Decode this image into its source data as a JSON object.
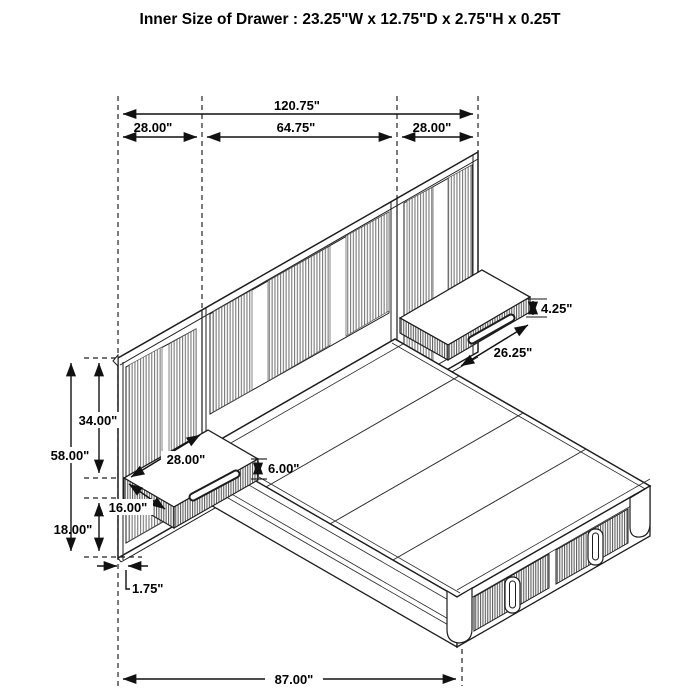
{
  "title": "Inner Size of Drawer : 23.25\"W x 12.75\"D x 2.75\"H x 0.25T",
  "dims": {
    "overall_width": "120.75\"",
    "left_panel_width": "28.00\"",
    "center_panel_width": "64.75\"",
    "right_panel_width": "28.00\"",
    "right_nightstand_height": "4.25\"",
    "right_nightstand_width": "26.25\"",
    "panel_top_to_nightstand": "34.00\"",
    "panel_height": "58.00\"",
    "left_nightstand_width": "28.00\"",
    "left_nightstand_height": "6.00\"",
    "left_nightstand_depth": "16.00\"",
    "nightstand_floor_clearance": "18.00\"",
    "panel_thickness": "1.75\"",
    "overall_depth": "87.00\""
  }
}
